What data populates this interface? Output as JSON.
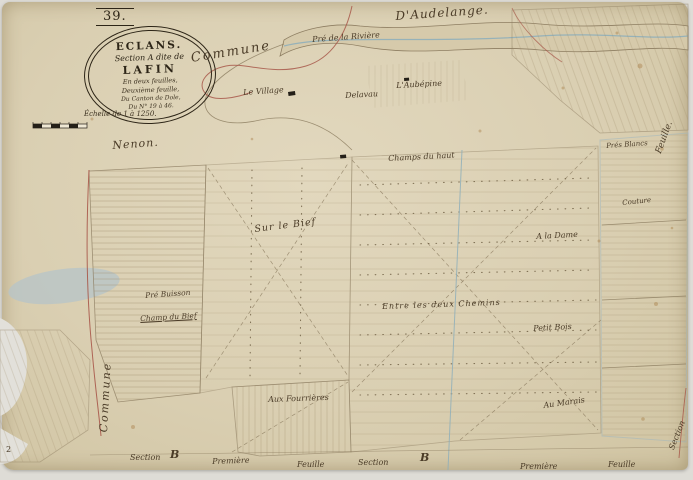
{
  "document_type": "cadastral-map-scan",
  "cartouche": {
    "page_number": "39.",
    "title": "ECLANS.",
    "subtitle": "Section A dite de",
    "name": "LAFIN",
    "line4": "En deux feuilles,",
    "line5": "Deuxième feuille,",
    "line6": "Du Canton de Dole,",
    "line7": "Du N° 19 à 46.",
    "scale": "Échelle de 1 à 1250."
  },
  "colors": {
    "paper": "#dacfb2",
    "ink": "#8a7a5e",
    "text_ink": "#4a3b27",
    "boundary_red": "#a8584a",
    "water_blue": "#8fafba",
    "stain_blue": "#b8c4c7"
  },
  "labels": [
    {
      "text": "D'Audelange."
    },
    {
      "text": "Commune"
    },
    {
      "text": "Pré de la Rivière"
    },
    {
      "text": "Nenon."
    },
    {
      "text": "Le Village"
    },
    {
      "text": "Delavau"
    },
    {
      "text": "L'Aubépine"
    },
    {
      "text": "Champs du haut"
    },
    {
      "text": "Prés Blancs"
    },
    {
      "text": "Couture"
    },
    {
      "text": "Sur le Bief"
    },
    {
      "text": "A la Dame"
    },
    {
      "text": "Entre les deux Chemins"
    },
    {
      "text": "Pré Buisson"
    },
    {
      "text": "Champ du Bief"
    },
    {
      "text": "Petit Bois"
    },
    {
      "text": "Aux Fourrières"
    },
    {
      "text": "Au Marais"
    },
    {
      "text": "Commune"
    },
    {
      "text": "Feuille."
    },
    {
      "text": "Section"
    },
    {
      "text": "Section"
    },
    {
      "text": "B"
    },
    {
      "text": "Première"
    },
    {
      "text": "Feuille"
    },
    {
      "text": "Section"
    },
    {
      "text": "B"
    },
    {
      "text": "Première"
    },
    {
      "text": "Feuille"
    },
    {
      "text": "2"
    }
  ]
}
